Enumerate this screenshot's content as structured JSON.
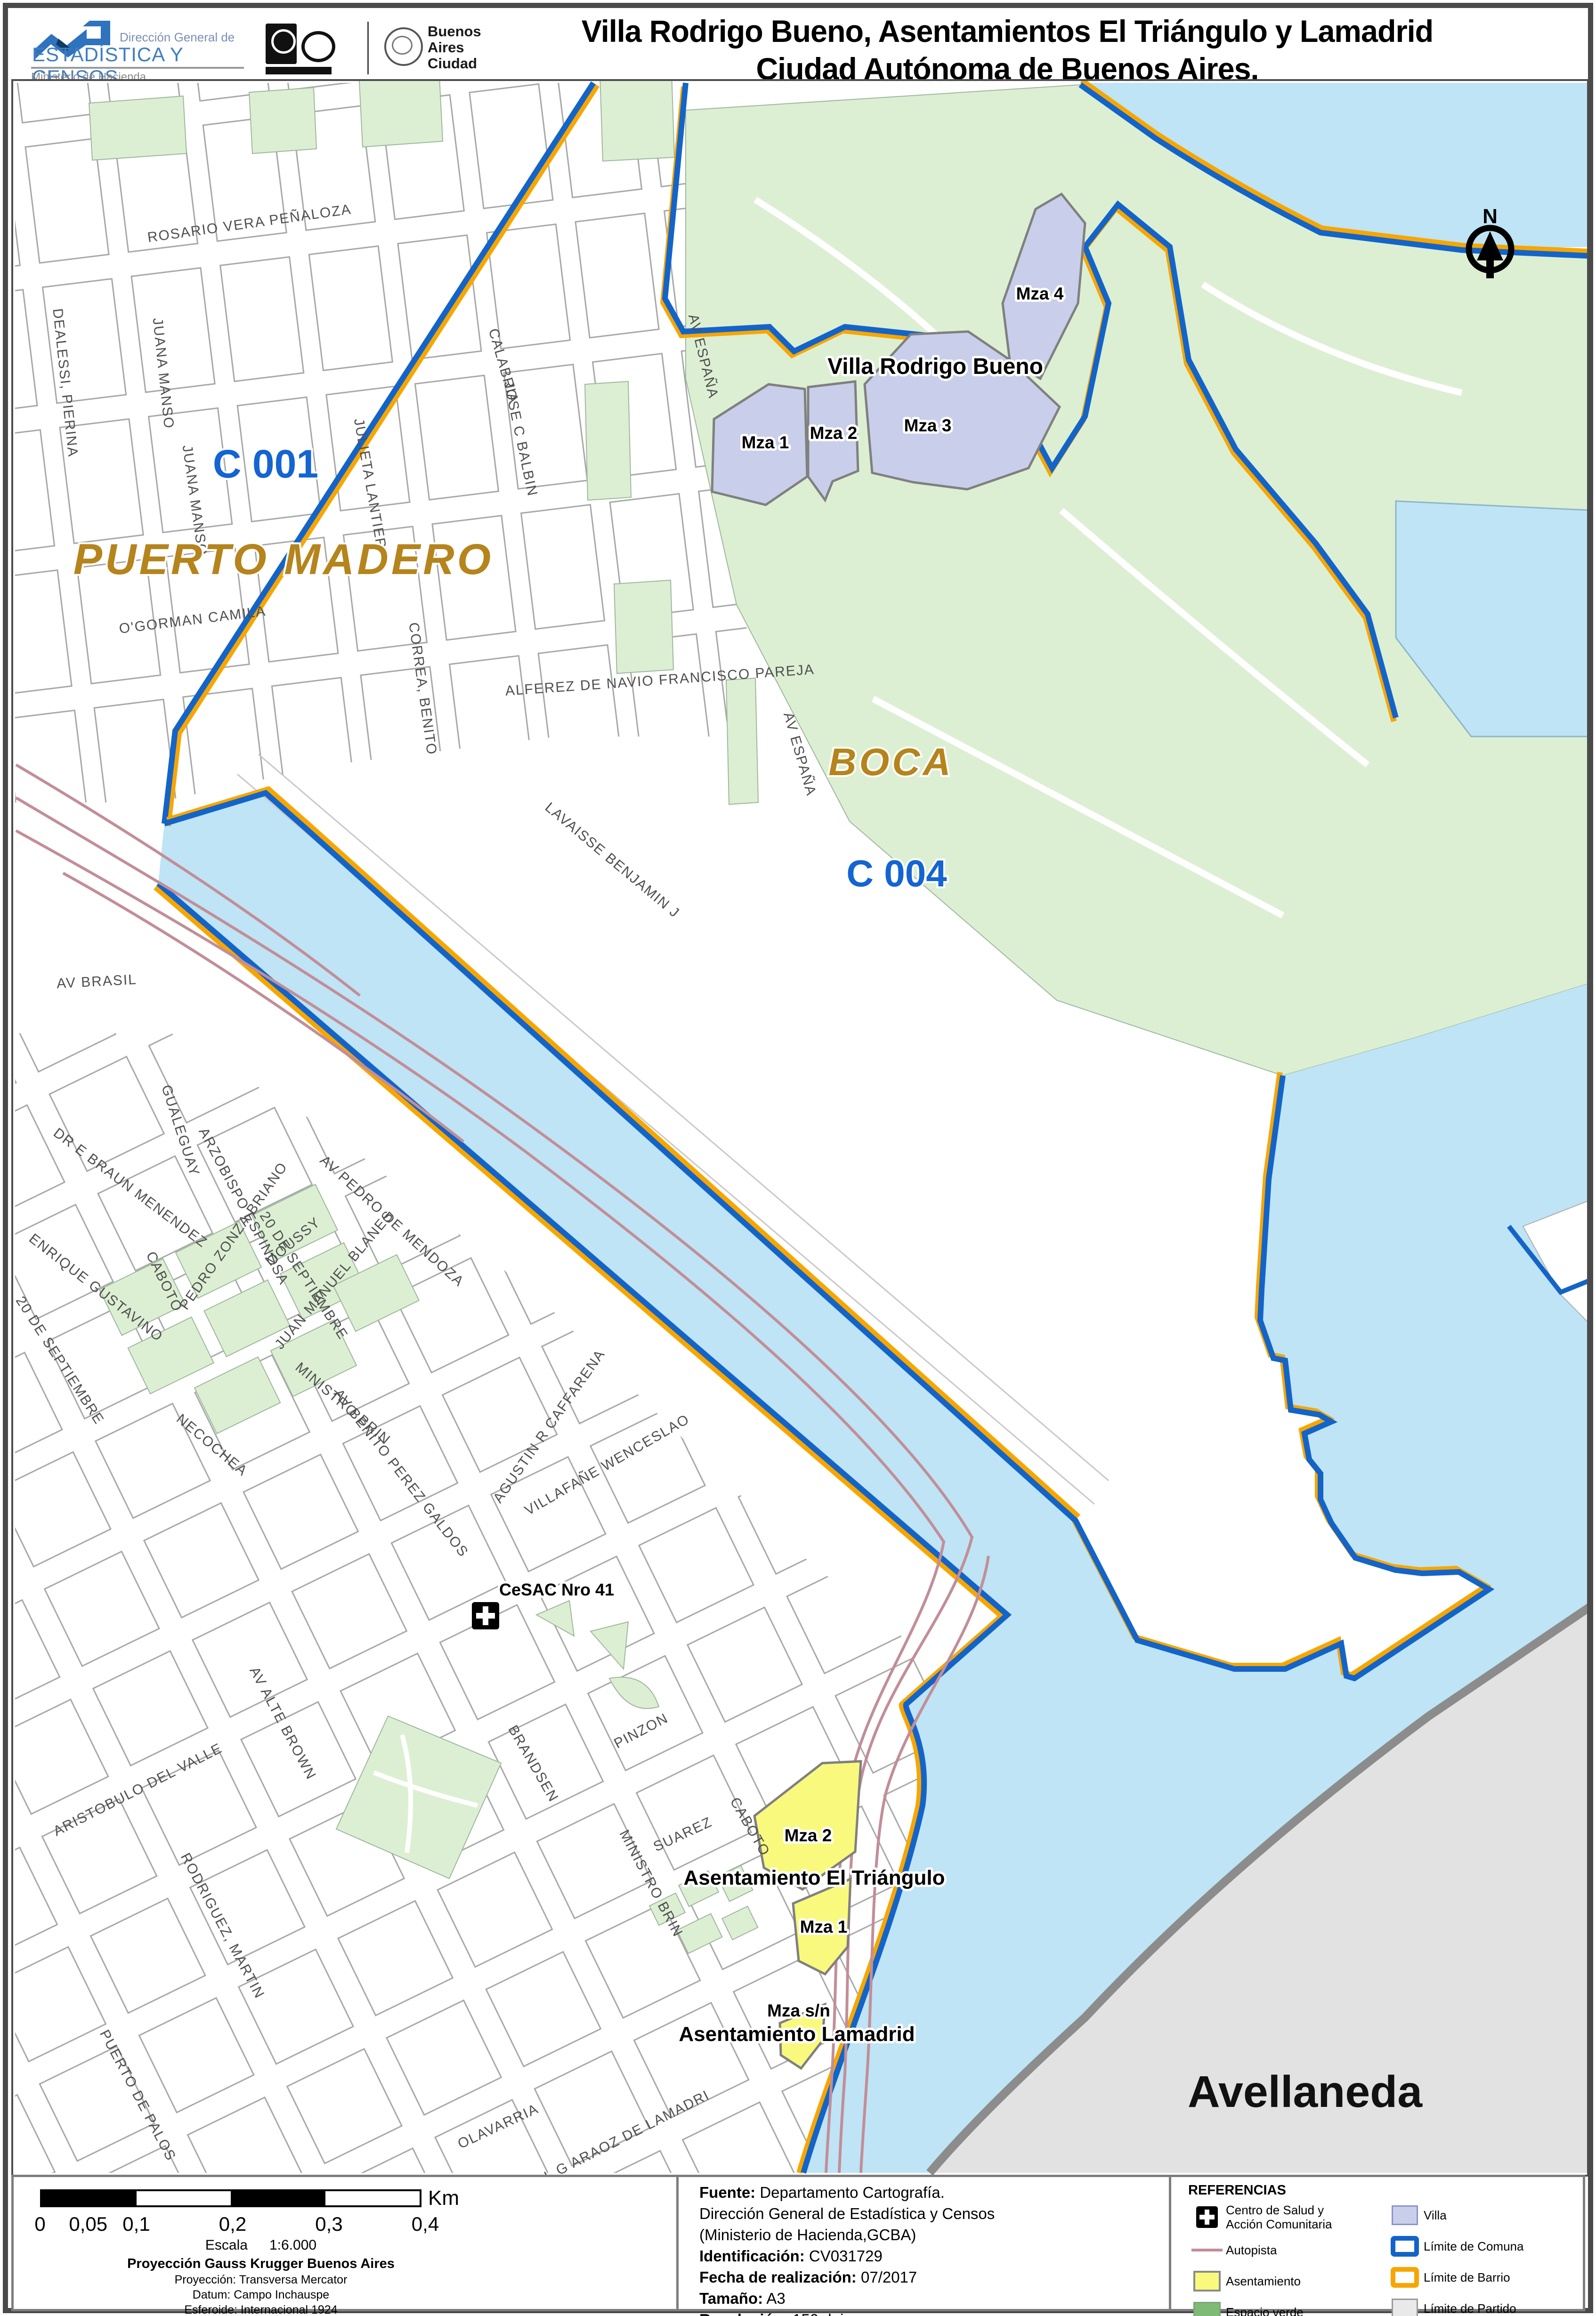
{
  "header": {
    "logo": {
      "line1": "Dirección General de",
      "name": "ESTADÍSTICA Y CENSOS",
      "ministry": "Ministerio de Hacienda"
    },
    "ba_logo": {
      "l1": "Buenos",
      "l2": "Aires",
      "l3": "Ciudad"
    },
    "title1": "Villa Rodrigo Bueno, Asentamientos El Triángulo y Lamadrid",
    "title2": "Ciudad Autónoma de Buenos Aires."
  },
  "map": {
    "north": "N",
    "areas": {
      "comuna1": "C 001",
      "barrio_pm": "PUERTO MADERO",
      "barrio_boca": "BOCA",
      "comuna4": "C 004",
      "partido": "Avellaneda",
      "villa_title": "Villa Rodrigo Bueno",
      "villa_mza1": "Mza 1",
      "villa_mza2": "Mza 2",
      "villa_mza3": "Mza 3",
      "villa_mza4": "Mza 4",
      "tri_title": "Asentamiento El Triángulo",
      "tri_mza2": "Mza 2",
      "tri_mza1": "Mza 1",
      "lam_title": "Asentamiento Lamadrid",
      "lam_mza": "Mza s/n",
      "cesac": "CeSAC Nro 41"
    },
    "streets": [
      "ROSARIO VERA PEÑALOZA",
      "DEALESSI, PIERINA",
      "JUANA MANSO",
      "JUANA MANSO",
      "JULIETA LANTIERI",
      "O'GORMAN CAMILA",
      "CORREA, BENITO",
      "JOSE C BALBIN",
      "CALABRIA",
      "ALFEREZ DE NAVIO FRANCISCO PAREJA",
      "AV ESPAÑA",
      "AV ESPAÑA",
      "LAVAISSE BENJAMIN J",
      "AV BRASIL",
      "GUALEGUAY",
      "ARZOBISPO ESPINOSA",
      "CABOTO",
      "20 DE SEPTIEMBRE",
      "AV PEDRO DE MENDOZA",
      "DR E BRAUN MENENDEZ",
      "ENRIQUE GUSTAVINO",
      "20 DE SEPTIEMBRE",
      "NECOCHEA",
      "PEDRO ZONZA BRIANO",
      "MOUSSY",
      "JUAN MANUEL BLANES",
      "MINISTRO BRIN",
      "AV BENITO PEREZ GALDOS",
      "AGUSTIN R CAFFARENA",
      "VILLAFAÑE WENCESLAO",
      "PINZON",
      "AV ALTE BROWN",
      "ARISTOBULO DEL VALLE",
      "RODRIGUEZ, MARTIN",
      "PUERTO DE PALOS",
      "OLAVARRIA",
      "GRAL G ARAOZ DE LAMADRI",
      "BRANDSEN",
      "SUAREZ",
      "MINISTRO BRIN",
      "CABOTO"
    ]
  },
  "footer": {
    "scale": {
      "unit": "Km",
      "ticks": [
        "0",
        "0,05",
        "0,1",
        "0,2",
        "0,3",
        "0,4"
      ],
      "escala_label": "Escala",
      "escala_value": "1:6.000",
      "proj_bold": "Proyección Gauss Krugger Buenos Aires",
      "lines": [
        "Proyección: Transversa Mercator",
        "Datum: Campo Inchauspe",
        "Esferoide: Internacional 1924",
        "Meridiano central: -58.4627",
        "Latitud de origen: -34.6297166"
      ]
    },
    "source": {
      "l1_label": "Fuente:",
      "l1": " Departamento Cartografía.",
      "l2": "Dirección General de Estadística y Censos",
      "l3": "(Ministerio de Hacienda,GCBA)",
      "l4_label": "Identificación:",
      "l4": " CV031729",
      "l5_label": "Fecha de realización:",
      "l5": " 07/2017",
      "l6_label": "Tamaño:",
      "l6": " A3",
      "l7_label": "Resolución:",
      "l7": " 150 dpi"
    },
    "legend": {
      "title": "REFERENCIAS",
      "items": {
        "cesac1": "Centro de Salud y",
        "cesac2": "Acción Comunitaria",
        "autopista": "Autopista",
        "asentamiento": "Asentamiento",
        "verde": "Espacio verde",
        "villa": "Villa",
        "comuna": "Límite de Comuna",
        "barrio": "Límite de Barrio",
        "partido": "Límite de Partido"
      }
    }
  },
  "colors": {
    "water": "#bee4f5",
    "espacio_verde": "#dcefd3",
    "villa": "#c9cfea",
    "asentamiento": "#f9f97d",
    "limite_comuna": "#1464c8",
    "limite_barrio": "#f7a600",
    "limite_partido": "#e2e2e2",
    "autopista": "#c28e98",
    "comuna_text": "#1464d2",
    "barrio_text": "#b5841c"
  }
}
